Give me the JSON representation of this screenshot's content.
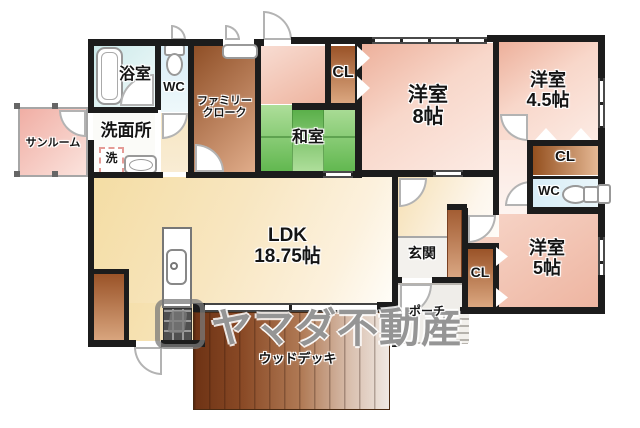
{
  "floorplan": {
    "watermark": {
      "text": "ヤマダ不動産"
    },
    "rooms": {
      "sunroom": {
        "label": "サンルーム"
      },
      "bath": {
        "label": "浴室"
      },
      "wc_top": {
        "label": "WC"
      },
      "washroom": {
        "label": "洗面所"
      },
      "washer": {
        "label": "洗"
      },
      "family_closet": {
        "line1": "ファミリー",
        "line2": "クローク"
      },
      "japanese_room": {
        "label": "和室"
      },
      "closet_top": {
        "label": "CL"
      },
      "bedroom_8": {
        "line1": "洋室",
        "line2": "8帖"
      },
      "bedroom_45": {
        "line1": "洋室",
        "line2": "4.5帖"
      },
      "closet_right": {
        "label": "CL"
      },
      "wc_right": {
        "label": "WC"
      },
      "bedroom_5": {
        "line1": "洋室",
        "line2": "5帖"
      },
      "closet_bottom": {
        "label": "CL"
      },
      "entrance": {
        "label": "玄関"
      },
      "porch": {
        "label": "ポーチ"
      },
      "ldk": {
        "line1": "LDK",
        "line2": "18.75帖"
      },
      "wood_deck": {
        "label": "ウッドデッキ"
      }
    },
    "colors": {
      "wall": "#1c1c1c",
      "ldk_cream": "#f8e6c0",
      "bedroom_pink": "#f3c6b4",
      "closet_brown": "#9a5328",
      "tatami_green": "#6cc75e",
      "water_blue": "#d8edf7",
      "bath_cyan": "#cbe9ea",
      "deck_brown": "#8a4a26",
      "sunroom_pink": "#f0aea4",
      "watermark_gray": "#7a7a7a"
    }
  }
}
